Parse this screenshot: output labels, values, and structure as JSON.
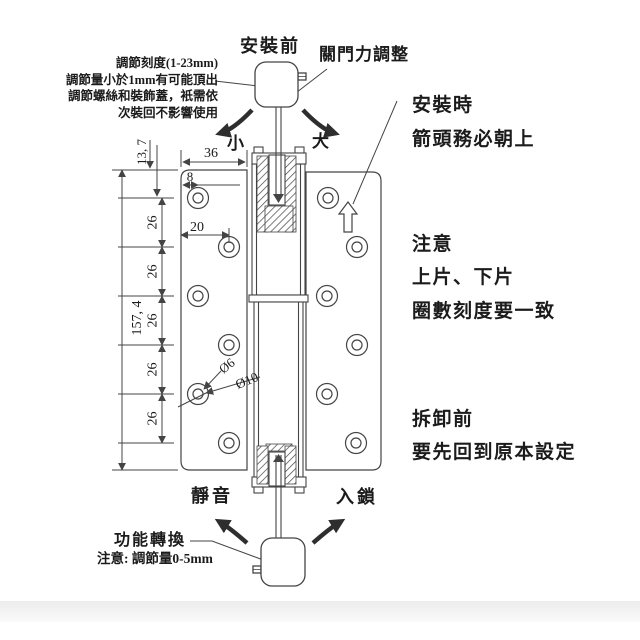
{
  "colors": {
    "line": "#444444",
    "arrow": "#2e2e2e",
    "text": "#1b1b1b",
    "band": "#ececec"
  },
  "top": {
    "before_install": "安裝前",
    "close_force": "關門力調整",
    "note_lines": [
      "調節刻度(1-23mm)",
      "調節量小於1mm有可能頂出",
      "調節螺絲和裝飾蓋，衹需依",
      "次裝回不影響使用"
    ],
    "small": "小",
    "large": "大"
  },
  "right": {
    "install_1": "安裝時",
    "install_2": "箭頭務必朝上",
    "caution_title": "注意",
    "caution_1": "上片、下片",
    "caution_2": "圈數刻度要一致",
    "removal_1": "拆卸前",
    "removal_2": "要先回到原本設定"
  },
  "bottom": {
    "silent": "靜音",
    "lock": "入鎖",
    "function_switch": "功能轉換",
    "function_note": "注意: 調節量0-5mm"
  },
  "dimensions": {
    "leaf_width": "36",
    "edge_to_hole": "8",
    "hole_offset": "20",
    "hole_pitch": "26",
    "total_height": "157, 4",
    "top_to_first_hole": "13, 7",
    "hole_dia_inner": "Ø6",
    "hole_dia_outer": "Ø10"
  }
}
